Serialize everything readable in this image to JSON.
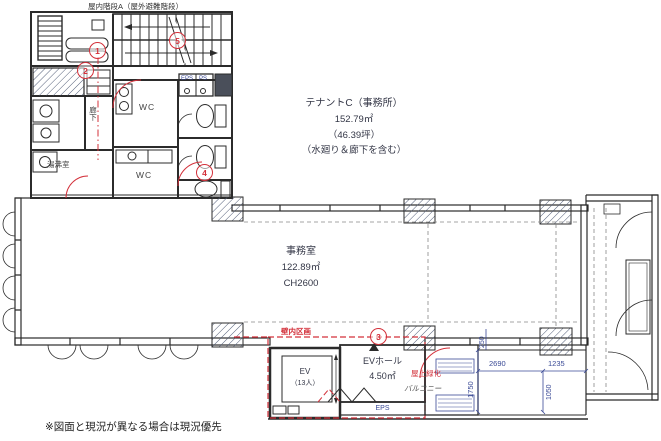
{
  "plan": {
    "stair_label": "屋内階段A（屋外避難階段）",
    "tenant": {
      "title": "テナントC（事務所）",
      "area": "152.79㎡",
      "tsubo": "（46.39坪）",
      "note": "（水廻り＆廊下を含む）"
    },
    "office": {
      "name": "事務室",
      "area": "122.89㎡",
      "ceiling": "CH2600"
    },
    "elevator": {
      "name": "EV",
      "capacity": "（13人）"
    },
    "ev_hall": {
      "name": "EVホール",
      "area": "4.50㎡"
    },
    "rooms": {
      "eps_top": "EPS",
      "ps_top": "PS",
      "eps_bottom": "EPS",
      "wc_upper": "WC",
      "wc_lower": "WC",
      "yuwakashi": "湯沸室",
      "rouka": "廊下"
    },
    "annotations": {
      "kabenai": "壁内区画",
      "ryokka": "屋上緑化",
      "balcony": "バルコニー",
      "footer": "※図面と現況が異なる場合は現況優先"
    },
    "dimensions": {
      "d2690": "2690",
      "d1235": "1235",
      "d1750": "1750",
      "d1050": "1050",
      "d250": "250"
    },
    "markers": [
      {
        "n": "1"
      },
      {
        "n": "2"
      },
      {
        "n": "3"
      },
      {
        "n": "4"
      },
      {
        "n": "5"
      }
    ],
    "colors": {
      "line": "#2b2b2b",
      "red": "#d3303a",
      "blue": "#3a4a96",
      "text": "#333646"
    }
  }
}
